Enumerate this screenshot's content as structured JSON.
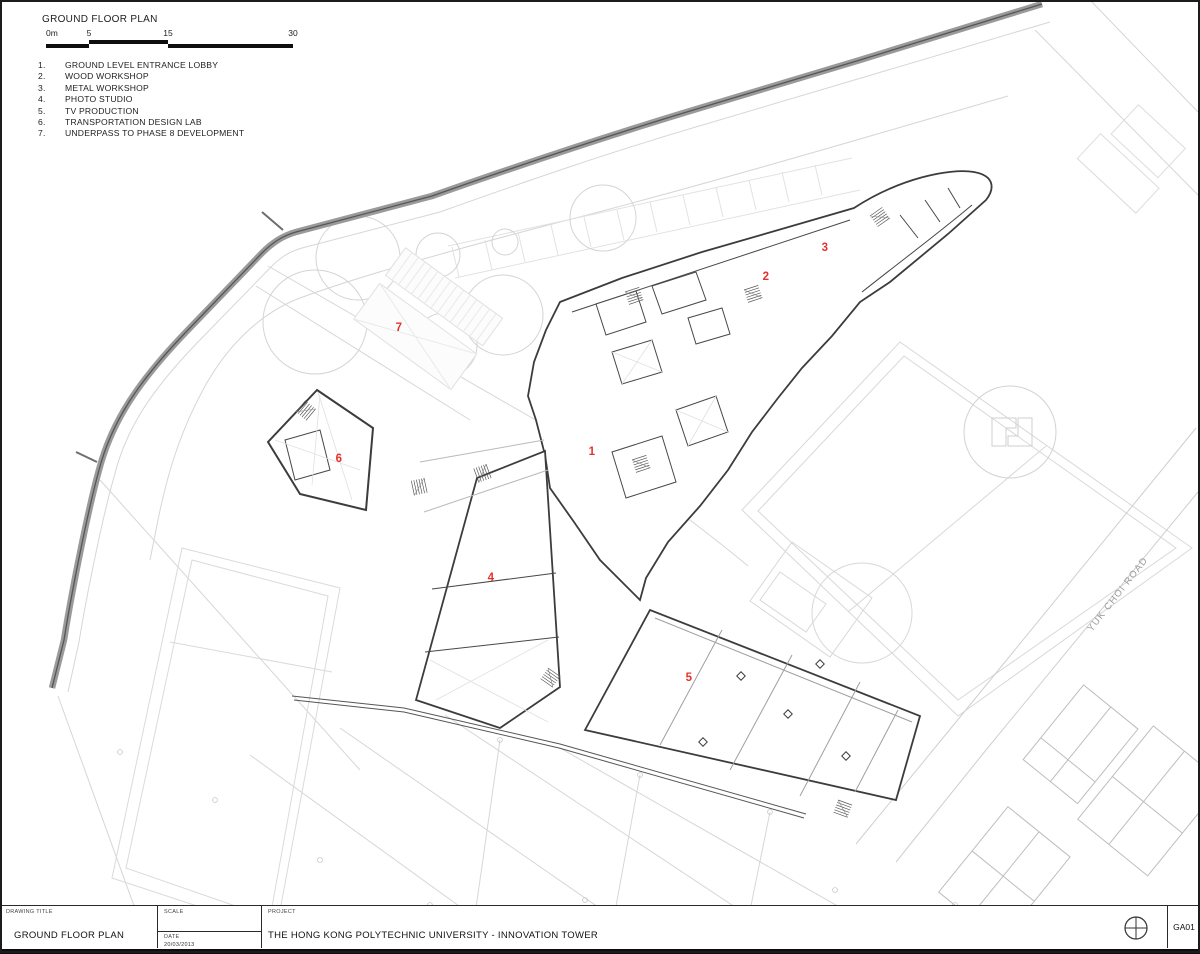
{
  "sheet": {
    "plan_title": "GROUND FLOOR PLAN",
    "scale_bar": {
      "labels": [
        "0m",
        "5",
        "15",
        "30"
      ]
    },
    "legend": {
      "items": [
        {
          "number": "1.",
          "label": "GROUND LEVEL ENTRANCE LOBBY"
        },
        {
          "number": "2.",
          "label": "WOOD WORKSHOP"
        },
        {
          "number": "3.",
          "label": "METAL WORKSHOP"
        },
        {
          "number": "4.",
          "label": "PHOTO STUDIO"
        },
        {
          "number": "5.",
          "label": "TV PRODUCTION"
        },
        {
          "number": "6.",
          "label": "TRANSPORTATION DESIGN LAB"
        },
        {
          "number": "7.",
          "label": "UNDERPASS TO PHASE 8 DEVELOPMENT"
        }
      ]
    },
    "plan": {
      "road_label": "YUK CHOI ROAD",
      "markers": [
        {
          "number": "1"
        },
        {
          "number": "2"
        },
        {
          "number": "3"
        },
        {
          "number": "4"
        },
        {
          "number": "5"
        },
        {
          "number": "6"
        },
        {
          "number": "7"
        }
      ]
    },
    "title_block": {
      "drawing_title_label": "DRAWING TITLE",
      "drawing_title": "GROUND FLOOR PLAN",
      "scale_label": "SCALE",
      "scale_value": "",
      "date_label": "DATE",
      "date_value": "20/03/2013",
      "project_label": "PROJECT",
      "project_name": "THE HONG KONG POLYTECHNIC UNIVERSITY - INNOVATION TOWER",
      "sheet_number": "GA01",
      "north_icon": "crosshair-circle-icon"
    },
    "colors": {
      "marker_red": "#e5322a",
      "wall_dark": "#3c3c3c",
      "road_gray": "#8f8f8f",
      "context_gray": "#d2d2d2"
    }
  }
}
